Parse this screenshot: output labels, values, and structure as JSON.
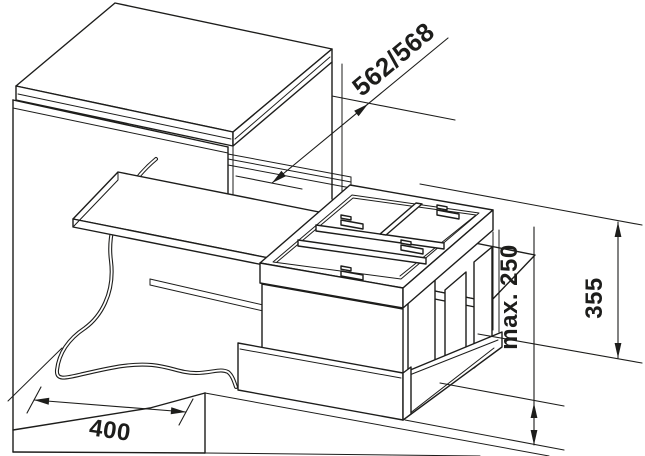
{
  "diagram": {
    "labels": {
      "depth": "562/568",
      "max_front_height": "max. 250",
      "system_height": "355",
      "width": "400"
    },
    "colors": {
      "line": "#1d1d1b",
      "background": "#ffffff"
    }
  }
}
